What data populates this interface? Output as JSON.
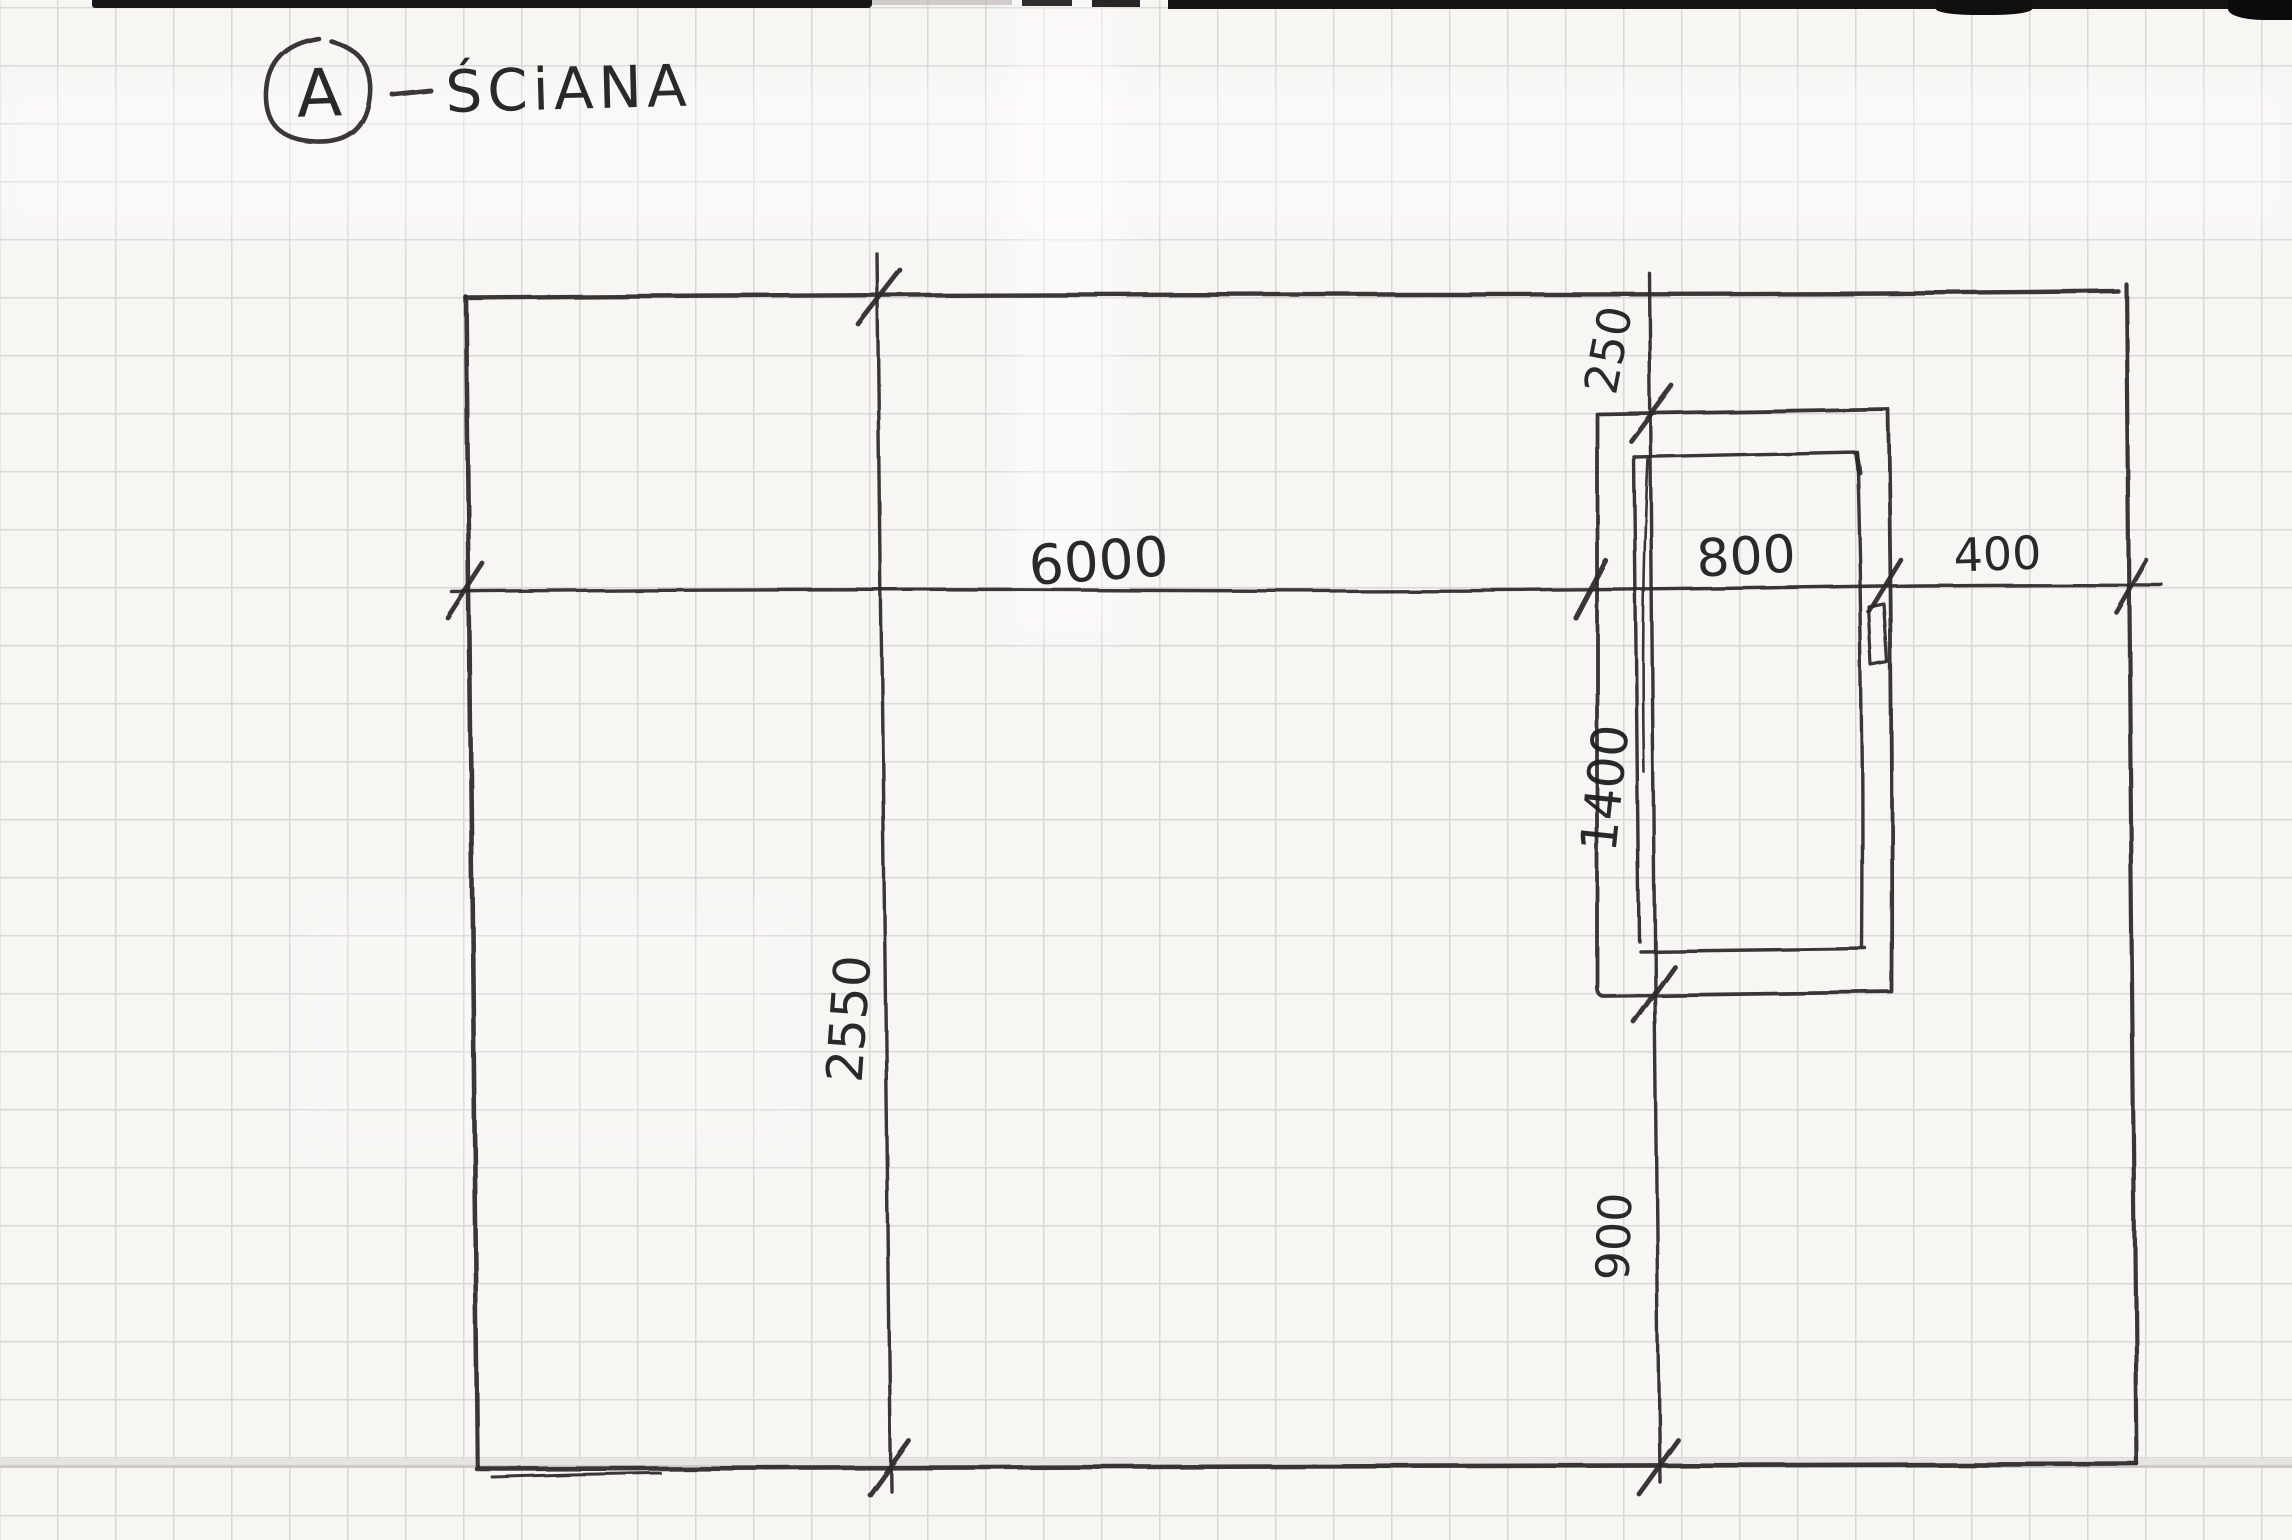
{
  "title": {
    "marker": "A",
    "dash": "–",
    "text": "ŚCiANA"
  },
  "dims": {
    "wall_length": "6000",
    "wall_height": "2550",
    "window_width": "800",
    "window_to_right_wall": "400",
    "window_to_top_wall": "250",
    "window_height": "1400",
    "window_to_floor": "900"
  },
  "colors": {
    "pencil": "#2b2a28",
    "grid_line": "#d9d8d6",
    "paper": "#f7f6f3",
    "scan_edge": "#141414"
  }
}
